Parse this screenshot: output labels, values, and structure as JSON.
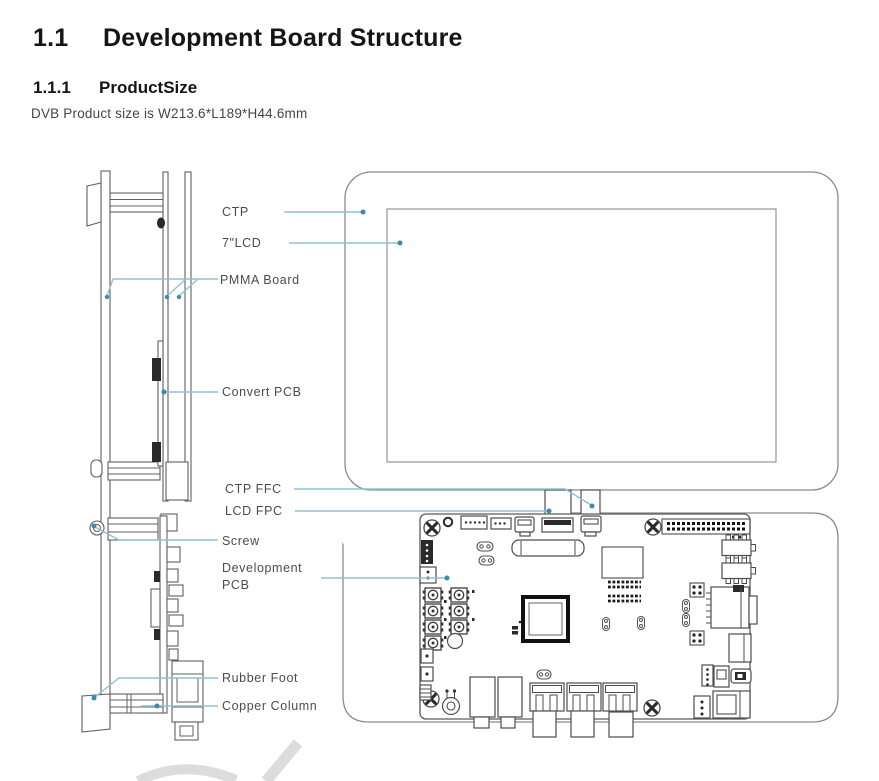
{
  "document": {
    "section_number": "1.1",
    "section_title": "Development Board Structure",
    "subsection_number": "1.1.1",
    "subsection_title": "ProductSize",
    "size_text": "DVB Product size is W213.6*L189*H44.6mm"
  },
  "diagram": {
    "labels": {
      "ctp": "CTP",
      "lcd7": "7\"LCD",
      "pmma": "PMMA Board",
      "convert": "Convert PCB",
      "ctp_ffc": "CTP FFC",
      "lcd_fpc": "LCD FPC",
      "screw": "Screw",
      "dev1": "Development",
      "dev2": "PCB",
      "rubber": "Rubber Foot",
      "copper": "Copper Column"
    },
    "colors": {
      "leader_line": "#8fc2d4",
      "leader_dot": "#3f89ac",
      "line_art": "#6f6f6f",
      "label_text": "#4c4c4c",
      "watermark_gray": "#dcdcdc",
      "heading_text": "#151515",
      "body_text": "#454545"
    }
  }
}
